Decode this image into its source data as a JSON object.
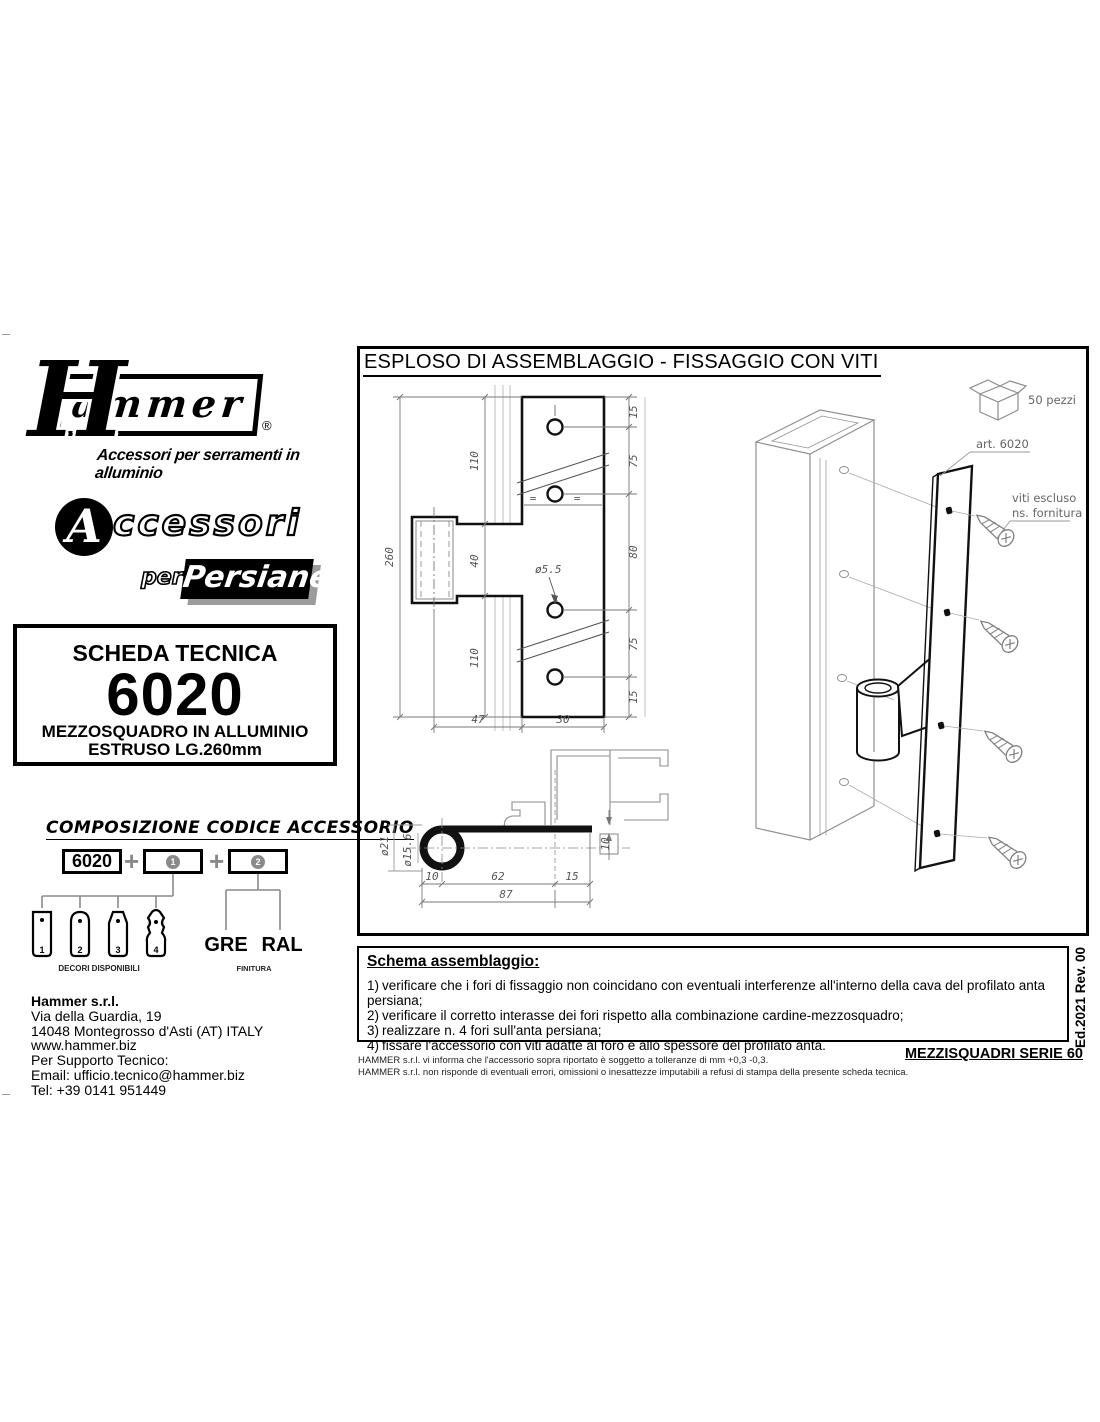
{
  "colors": {
    "ink": "#000000",
    "gray_accent": "#8a8a8a",
    "dim_line": "#777777",
    "shadow_gray": "#9b9b9b"
  },
  "branding": {
    "logo_initial": "H",
    "logo_rest": "ammer",
    "registered": "®",
    "tagline": "Accessori per serramenti in alluminio",
    "accessori_initial": "A",
    "accessori_rest": "ccessori",
    "per": "per",
    "persiane": "Persiane"
  },
  "tech_card": {
    "title": "SCHEDA TECNICA",
    "code": "6020",
    "line1": "MEZZOSQUADRO IN ALLUMINIO",
    "line2": "ESTRUSO LG.260mm"
  },
  "composition": {
    "heading": "COMPOSIZIONE CODICE ACCESSORIO",
    "base_code": "6020",
    "plus": "+",
    "slot1_num": "1",
    "slot2_num": "2",
    "decors": [
      "1",
      "2",
      "3",
      "4"
    ],
    "decors_label": "DECORI DISPONIBILI",
    "finishes": [
      "GRE",
      "RAL"
    ],
    "finishes_label": "FINITURA"
  },
  "company": {
    "name": "Hammer s.r.l.",
    "address_line1": "Via della Guardia, 19",
    "address_line2": "14048 Montegrosso d'Asti (AT) ITALY",
    "website": "www.hammer.biz",
    "support_label": "Per Supporto Tecnico:",
    "email": "Email: ufficio.tecnico@hammer.biz",
    "phone": "Tel: +39 0141 951449"
  },
  "drawing": {
    "title": "ESPLOSO DI ASSEMBLAGGIO - FISSAGGIO CON VITI",
    "front": {
      "total": "260",
      "seg_top": "110",
      "seg_mid": "40",
      "seg_bot": "110",
      "edge_top": "15",
      "pitch1": "75",
      "pitch2": "80",
      "pitch3": "75",
      "edge_bot": "15",
      "hole_dia": "ø5.5",
      "eq_left": "=",
      "eq_right": "=",
      "width_hub": "47",
      "width_plate": "30"
    },
    "section": {
      "outer_dia": "ø21",
      "inner_dia": "ø15.6",
      "seg1": "10",
      "seg2": "62",
      "seg3": "15",
      "total": "87",
      "thickness": "10"
    },
    "iso": {
      "art": "art. 6020",
      "note1": "viti escluso",
      "note2": "ns. fornitura",
      "package": "50 pezzi"
    }
  },
  "assembly": {
    "heading": "Schema assemblaggio:",
    "steps": [
      {
        "num": "1)",
        "text": "verificare che i fori di fissaggio non coincidano con eventuali interferenze all'interno della cava del profilato anta persiana;"
      },
      {
        "num": "2)",
        "text": "verificare il corretto interasse dei fori rispetto alla combinazione cardine-mezzosquadro;"
      },
      {
        "num": "3)",
        "text": "realizzare n. 4 fori sull'anta persiana;"
      },
      {
        "num": "4)",
        "text": "fissare l'accessorio con viti adatte al foro e allo spessore del profilato anta."
      }
    ]
  },
  "footer": {
    "disclaimer1": "HAMMER s.r.l. vi informa che l'accessorio sopra riportato è soggetto a tolleranze di mm +0,3 -0,3.",
    "disclaimer2": "HAMMER s.r.l. non risponde di eventuali errori, omissioni o inesattezze imputabili a refusi di stampa della presente scheda tecnica.",
    "series": "MEZZISQUADRI SERIE 60",
    "edition": "Ed.2021 Rev. 00"
  }
}
